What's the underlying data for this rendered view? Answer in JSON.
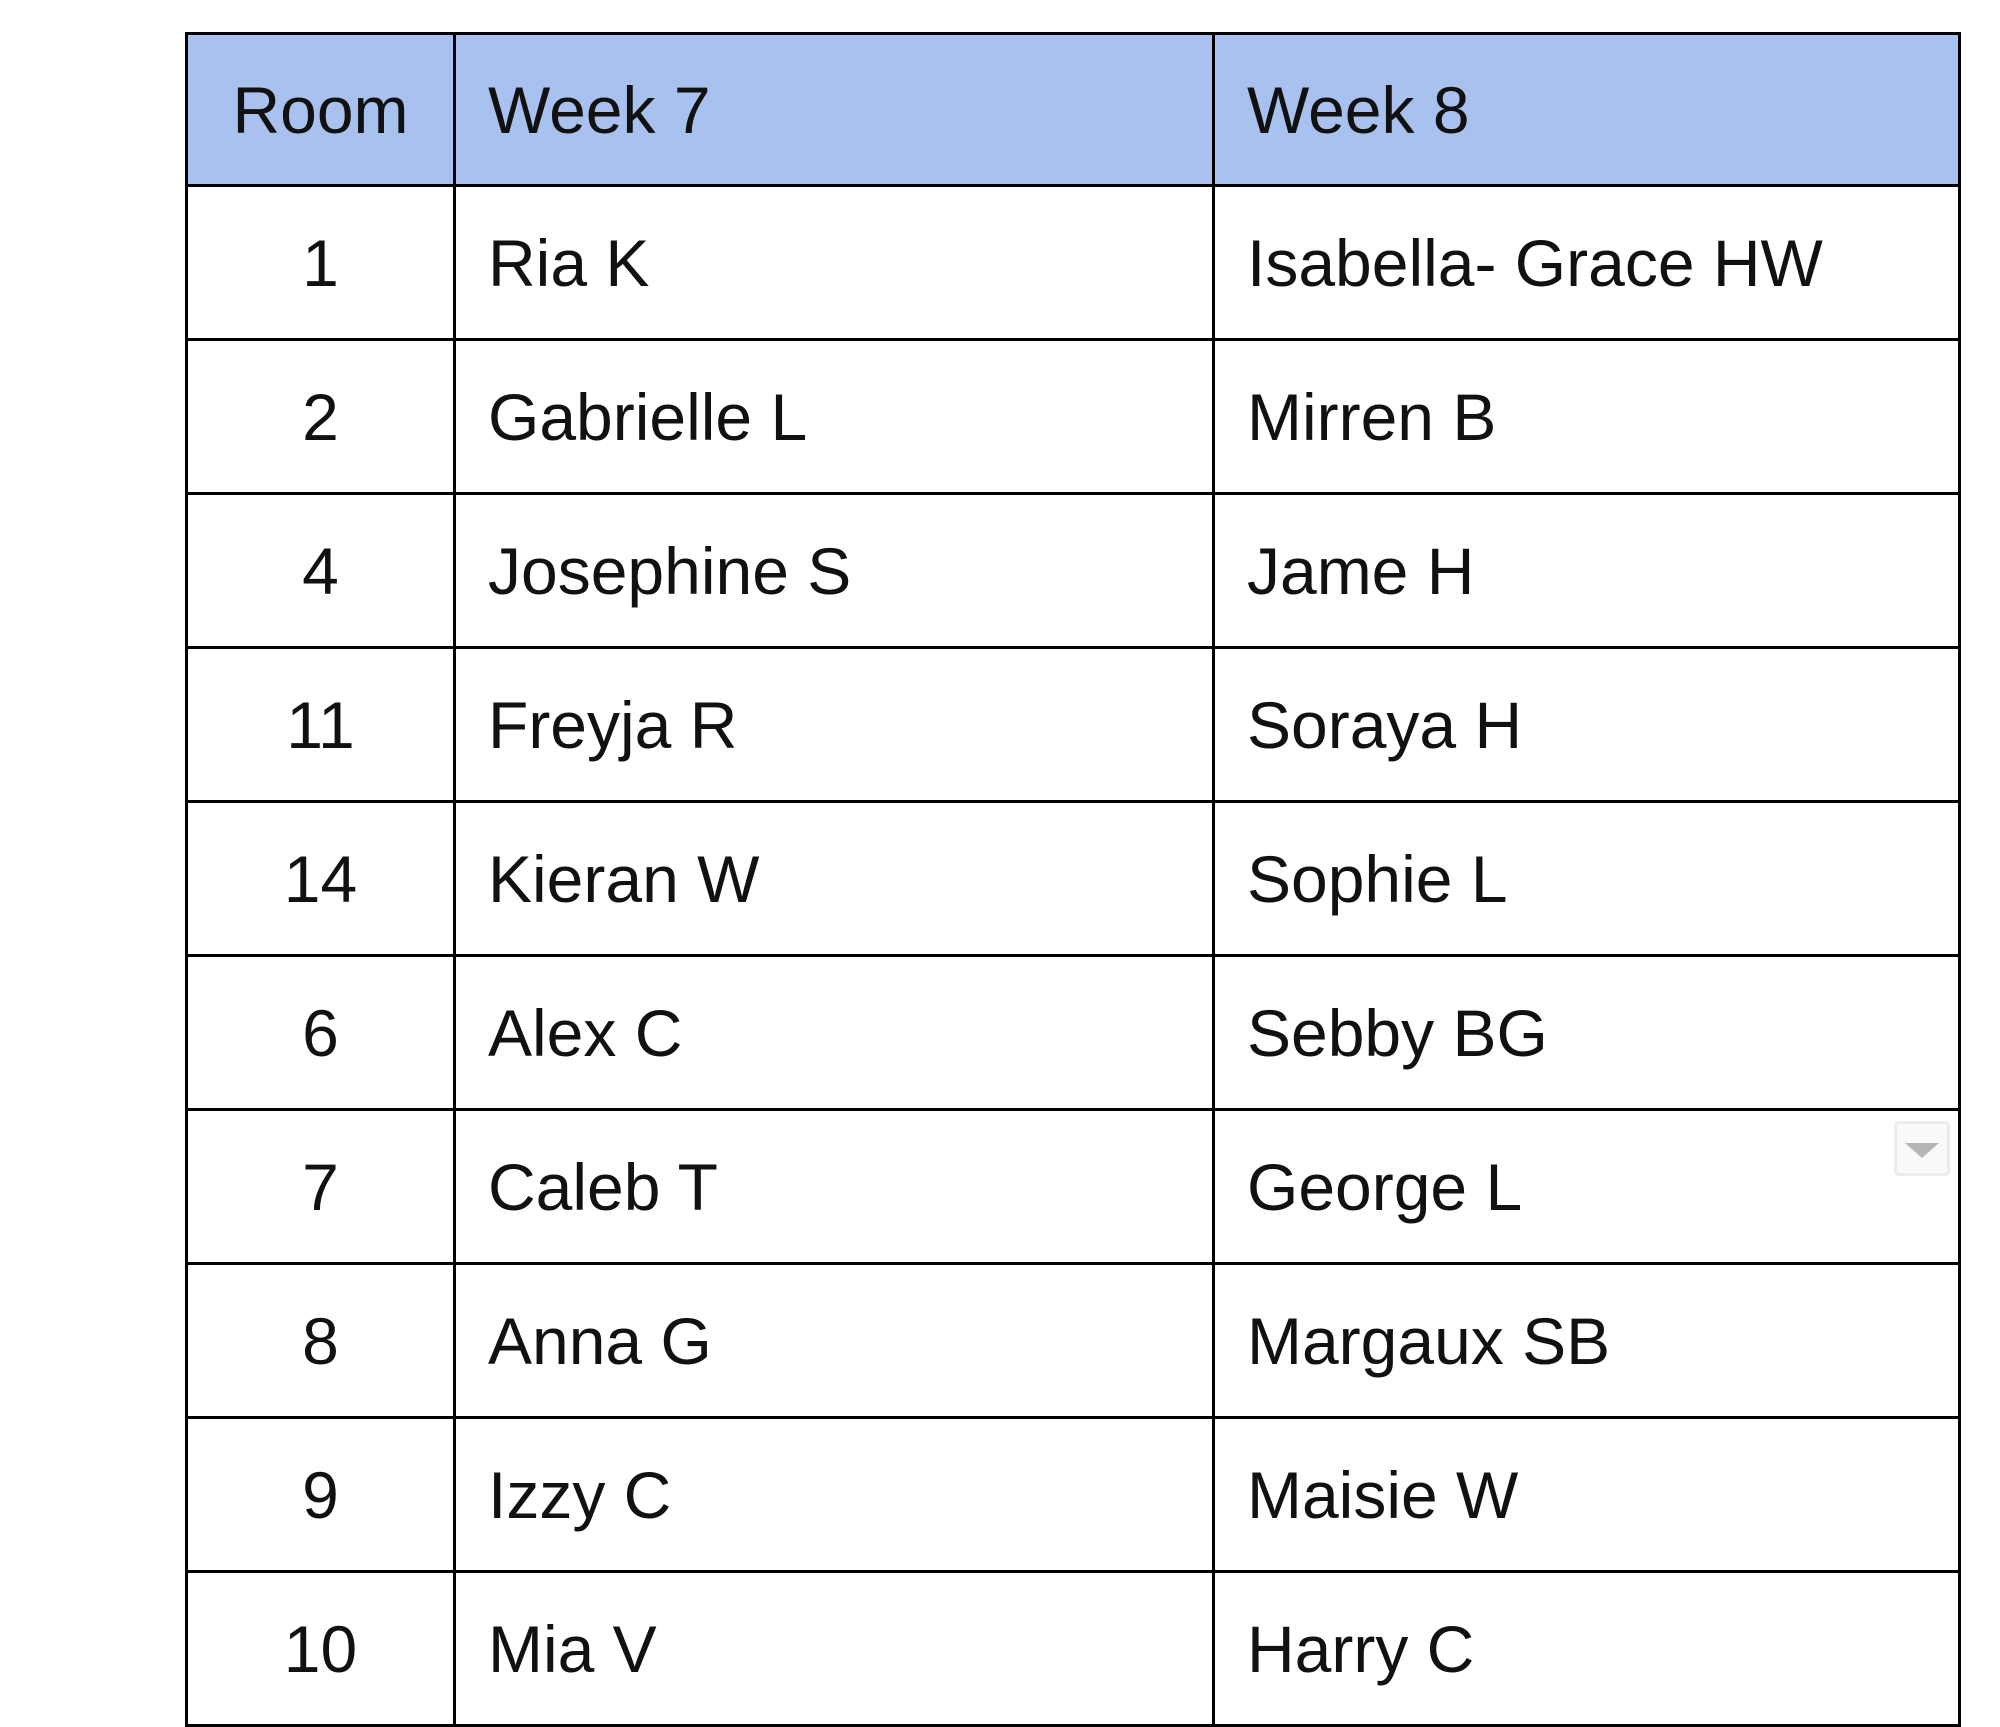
{
  "table": {
    "columns": [
      {
        "key": "room",
        "label": "Room"
      },
      {
        "key": "week7",
        "label": "Week 7"
      },
      {
        "key": "week8",
        "label": "Week 8"
      }
    ],
    "rows": [
      {
        "room": "1",
        "week7": "Ria K",
        "week8": "Isabella- Grace HW",
        "has_dropdown": false
      },
      {
        "room": "2",
        "week7": "Gabrielle L",
        "week8": "Mirren B",
        "has_dropdown": false
      },
      {
        "room": "4",
        "week7": "Josephine S",
        "week8": "Jame H",
        "has_dropdown": false
      },
      {
        "room": "11",
        "week7": "Freyja R",
        "week8": "Soraya H",
        "has_dropdown": false
      },
      {
        "room": "14",
        "week7": "Kieran W",
        "week8": "Sophie L",
        "has_dropdown": false
      },
      {
        "room": "6",
        "week7": "Alex C",
        "week8": "Sebby BG",
        "has_dropdown": false
      },
      {
        "room": "7",
        "week7": "Caleb T",
        "week8": "George L",
        "has_dropdown": true
      },
      {
        "room": "8",
        "week7": "Anna G",
        "week8": "Margaux SB",
        "has_dropdown": false
      },
      {
        "room": "9",
        "week7": "Izzy C",
        "week8": "Maisie W",
        "has_dropdown": false
      },
      {
        "room": "10",
        "week7": "Mia V",
        "week8": "Harry C",
        "has_dropdown": false
      }
    ],
    "colors": {
      "header_bg": "#a9c1ef",
      "border": "#000000",
      "text": "#111111",
      "dropdown_triangle": "#b5b5b5"
    }
  }
}
